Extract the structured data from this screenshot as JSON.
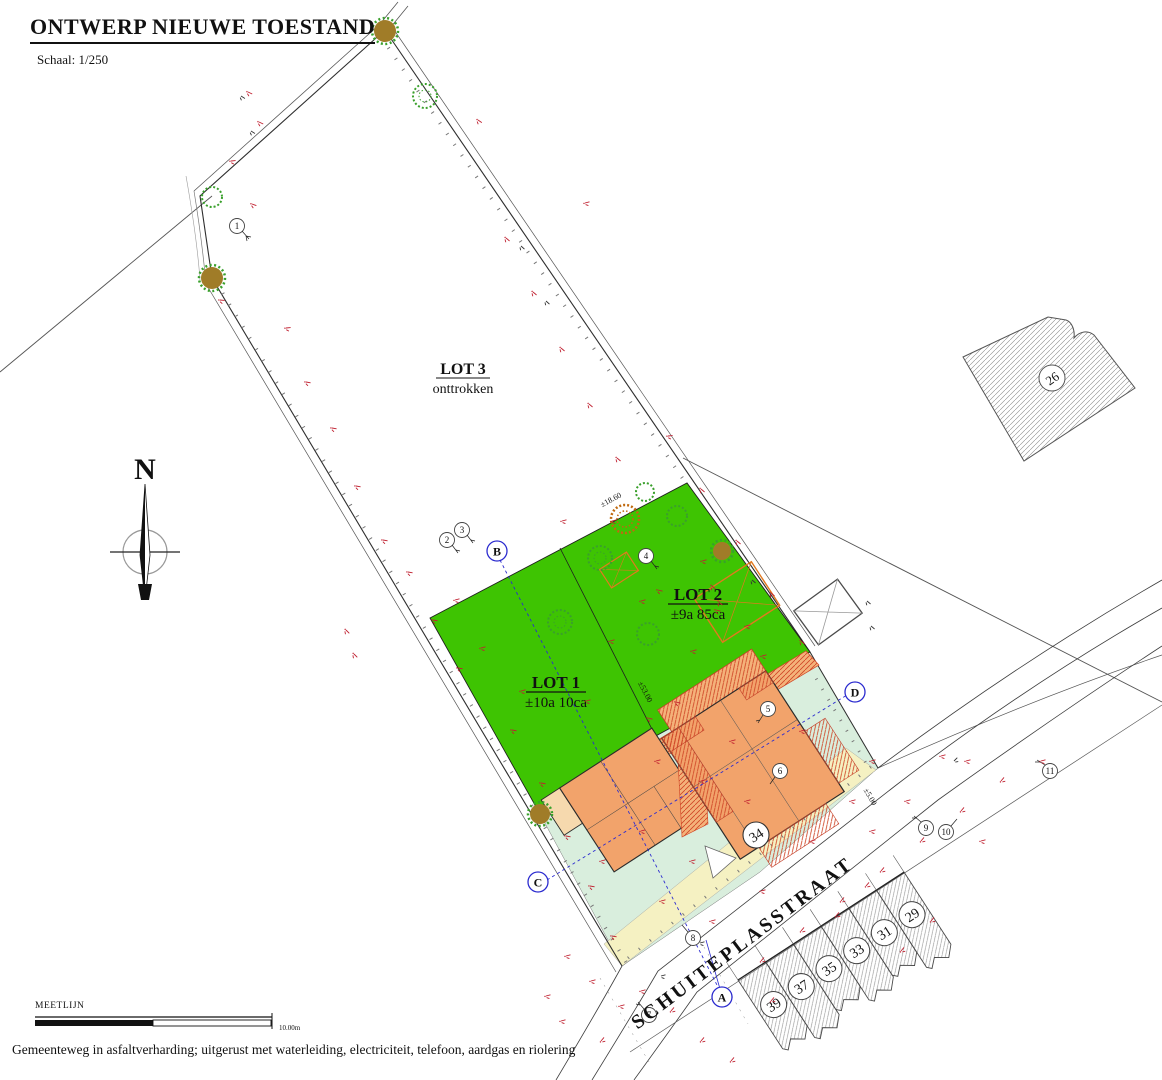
{
  "title": {
    "text": "ONTWERP NIEUWE TOESTAND",
    "scale": "Schaal: 1/250"
  },
  "compass": {
    "label": "N"
  },
  "lots": {
    "lot3": {
      "name": "LOT 3",
      "status": "onttrokken"
    },
    "lot2": {
      "name": "LOT 2",
      "area": "±9a 85ca"
    },
    "lot1": {
      "name": "LOT 1",
      "area": "±10a 10ca"
    }
  },
  "street": {
    "name": "SCHUITEPLASSTRAAT"
  },
  "buildings": {
    "existing_house_label": "34",
    "neighbor_building_label": "26",
    "house_numbers": [
      "39",
      "37",
      "35",
      "33",
      "31",
      "29"
    ]
  },
  "section_markers": {
    "a": "A",
    "b": "B",
    "c": "C",
    "d": "D"
  },
  "point_markers": [
    "1",
    "2",
    "3",
    "4",
    "5",
    "6",
    "7",
    "8",
    "9",
    "10",
    "11"
  ],
  "dimensions": {
    "lot2_frontage": "±18.60",
    "lot_depth": "±53.00",
    "side": "±5.00"
  },
  "legend": {
    "meetlijn": "MEETLIJN",
    "scalebar": "10.00m"
  },
  "footnote": "Gemeenteweg in asfaltverharding; uitgerust met waterleiding, electriciteit, telefoon, aardgas en riolering",
  "colors": {
    "lot_green": "#3ec402",
    "building_orange": "#f2a36b",
    "hatch_base": "#f4b27a",
    "hatch_red": "#cf4425",
    "mint": "#d9eedd",
    "cream": "#f5f1c2",
    "marker_blue": "#2c2ccf",
    "annotation_red": "#c02030",
    "structure_orange": "#e2791f"
  },
  "survey_marks": [
    [
      248,
      92,
      40
    ],
    [
      259,
      122,
      40
    ],
    [
      231,
      161,
      10
    ],
    [
      252,
      204,
      35
    ],
    [
      220,
      300,
      20
    ],
    [
      286,
      328,
      10
    ],
    [
      306,
      382,
      25
    ],
    [
      332,
      428,
      25
    ],
    [
      356,
      486,
      25
    ],
    [
      383,
      540,
      25
    ],
    [
      346,
      630,
      60
    ],
    [
      354,
      654,
      60
    ],
    [
      408,
      572,
      25
    ],
    [
      433,
      620,
      25
    ],
    [
      458,
      668,
      25
    ],
    [
      512,
      730,
      25
    ],
    [
      541,
      783,
      25
    ],
    [
      566,
      836,
      25
    ],
    [
      590,
      886,
      25
    ],
    [
      612,
      936,
      25
    ],
    [
      585,
      203,
      0
    ],
    [
      478,
      120,
      50
    ],
    [
      506,
      238,
      55
    ],
    [
      533,
      292,
      55
    ],
    [
      561,
      348,
      55
    ],
    [
      589,
      404,
      55
    ],
    [
      617,
      458,
      55
    ],
    [
      668,
      436,
      10
    ],
    [
      701,
      489,
      55
    ],
    [
      737,
      541,
      55
    ],
    [
      771,
      593,
      55
    ],
    [
      801,
      641,
      55
    ],
    [
      455,
      600,
      0
    ],
    [
      481,
      648,
      0
    ],
    [
      521,
      691,
      0
    ],
    [
      610,
      641,
      0
    ],
    [
      586,
      701,
      0
    ],
    [
      641,
      601,
      0
    ],
    [
      702,
      561,
      0
    ],
    [
      746,
      626,
      0
    ],
    [
      762,
      656,
      0
    ],
    [
      692,
      651,
      0
    ],
    [
      562,
      521,
      0
    ],
    [
      612,
      521,
      0
    ],
    [
      658,
      590,
      30
    ],
    [
      716,
      610,
      30
    ],
    [
      712,
      586,
      57
    ],
    [
      719,
      602,
      57
    ],
    [
      656,
      761,
      0
    ],
    [
      701,
      781,
      0
    ],
    [
      731,
      741,
      0
    ],
    [
      801,
      731,
      0
    ],
    [
      746,
      801,
      0
    ],
    [
      691,
      861,
      0
    ],
    [
      641,
      831,
      0
    ],
    [
      601,
      861,
      0
    ],
    [
      661,
      901,
      0
    ],
    [
      711,
      921,
      0
    ],
    [
      761,
      891,
      0
    ],
    [
      811,
      841,
      0
    ],
    [
      851,
      801,
      0
    ],
    [
      871,
      761,
      0
    ],
    [
      648,
      718,
      30
    ],
    [
      676,
      702,
      30
    ],
    [
      641,
      991,
      0
    ],
    [
      671,
      1011,
      -35
    ],
    [
      701,
      1041,
      -35
    ],
    [
      731,
      1061,
      -35
    ],
    [
      601,
      1041,
      -35
    ],
    [
      561,
      1021,
      0
    ],
    [
      761,
      961,
      -35
    ],
    [
      801,
      931,
      -35
    ],
    [
      841,
      901,
      -35
    ],
    [
      881,
      871,
      -35
    ],
    [
      921,
      841,
      -35
    ],
    [
      961,
      811,
      -35
    ],
    [
      1001,
      781,
      -35
    ],
    [
      901,
      951,
      -35
    ],
    [
      931,
      921,
      -35
    ],
    [
      771,
      1001,
      -35
    ],
    [
      836,
      916,
      -35
    ],
    [
      866,
      886,
      -35
    ],
    [
      941,
      756,
      0
    ],
    [
      966,
      761,
      0
    ],
    [
      1041,
      761,
      0
    ],
    [
      906,
      801,
      0
    ],
    [
      871,
      831,
      0
    ],
    [
      981,
      841,
      0
    ],
    [
      591,
      981,
      0
    ],
    [
      566,
      956,
      0
    ],
    [
      546,
      996,
      0
    ],
    [
      620,
      1006,
      0
    ]
  ],
  "dark_marks": [
    [
      241,
      96,
      47
    ],
    [
      251,
      131,
      47
    ],
    [
      521,
      246,
      57
    ],
    [
      546,
      301,
      57
    ],
    [
      867,
      601,
      55
    ],
    [
      871,
      626,
      55
    ],
    [
      954,
      761,
      -30
    ],
    [
      700,
      943,
      0
    ],
    [
      661,
      976,
      0
    ],
    [
      752,
      580,
      55
    ]
  ]
}
